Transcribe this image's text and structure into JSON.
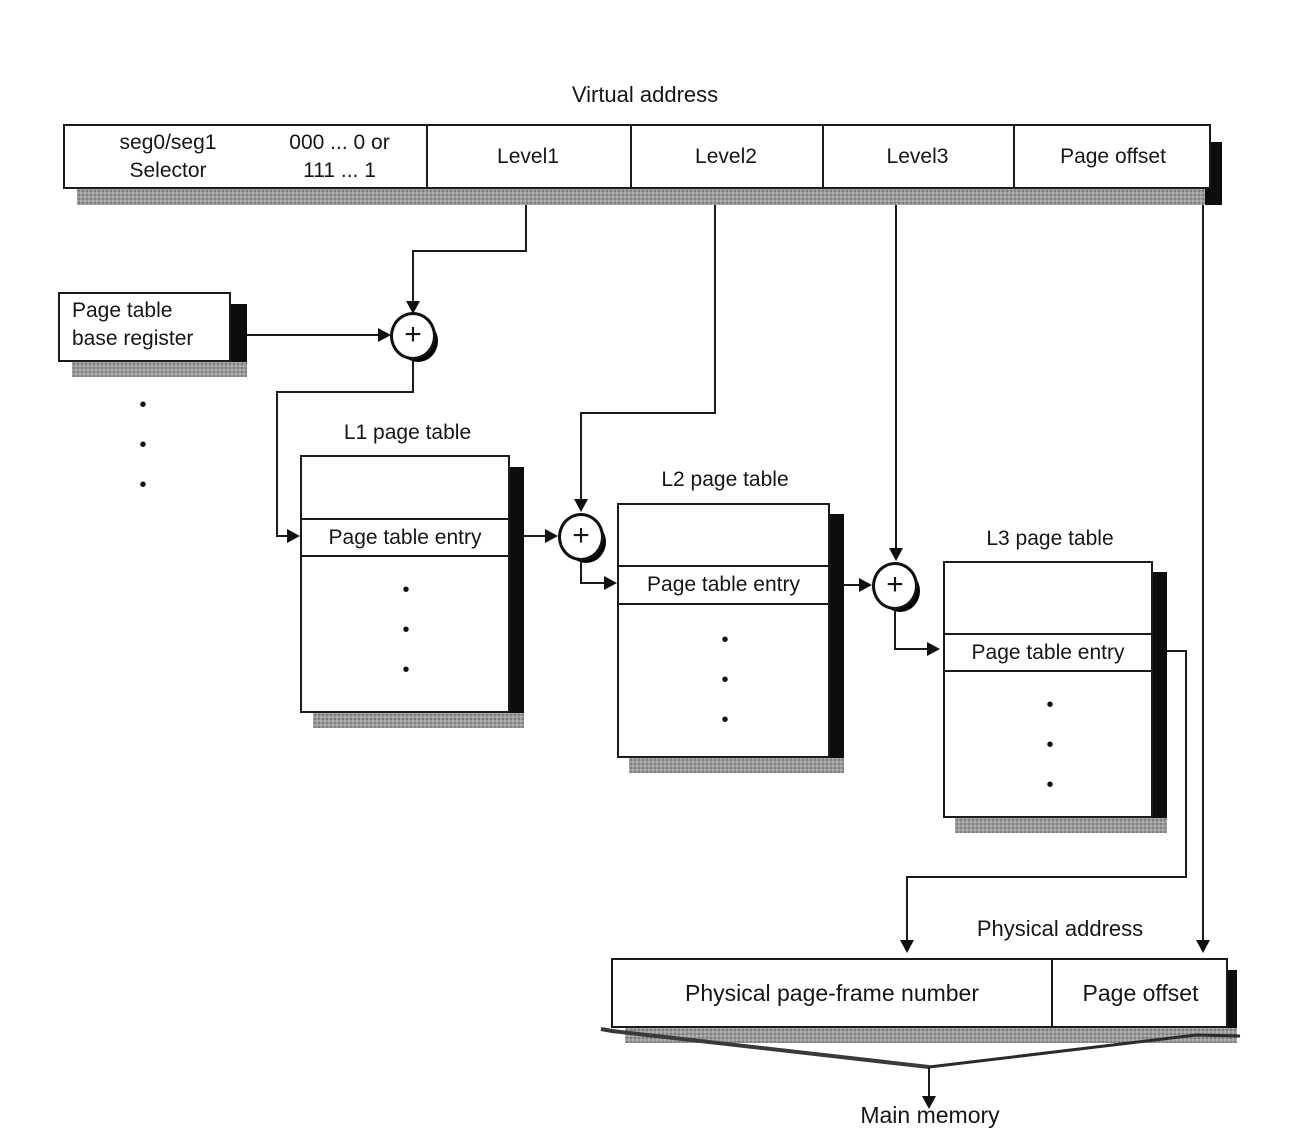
{
  "virtual_address": {
    "label": "Virtual address",
    "selector_line1": "seg0/seg1",
    "selector_line2": "Selector",
    "bits_line1": "000 ... 0 or",
    "bits_line2": "111 ... 1",
    "level1": "Level1",
    "level2": "Level2",
    "level3": "Level3",
    "page_offset": "Page offset"
  },
  "base_register": {
    "line1": "Page table",
    "line2": "base register"
  },
  "tables": {
    "l1": {
      "title": "L1 page table",
      "entry": "Page table entry"
    },
    "l2": {
      "title": "L2 page table",
      "entry": "Page table entry"
    },
    "l3": {
      "title": "L3 page table",
      "entry": "Page table entry"
    }
  },
  "physical_address": {
    "label": "Physical address",
    "frame": "Physical page-frame number",
    "offset": "Page offset"
  },
  "main_memory": {
    "label": "Main memory"
  },
  "glyphs": {
    "plus": "+",
    "dot": "•"
  },
  "colors": {
    "ink": "#161616",
    "paper": "#ffffff",
    "shadow": "#9b9b9b"
  }
}
